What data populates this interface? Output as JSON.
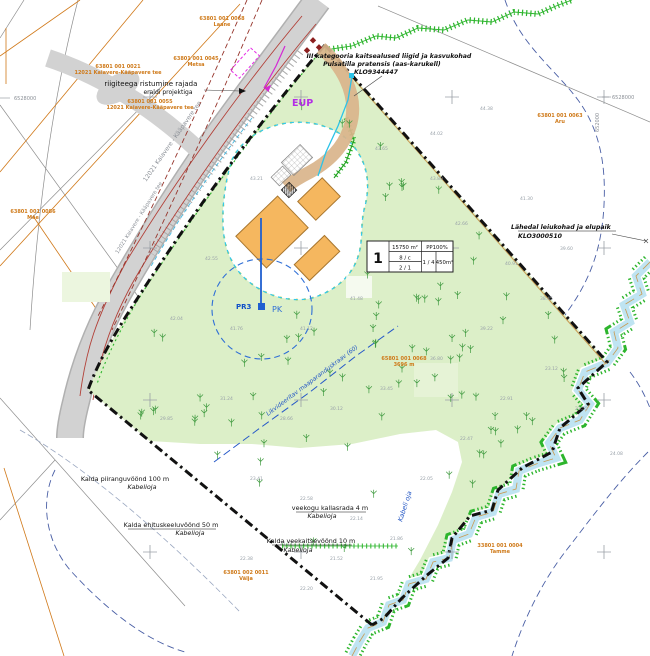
{
  "labels": {
    "road_crossing": {
      "l1": "riigiteega ristumine rajada",
      "l2": "eraldi projektiga"
    },
    "species": {
      "l1": "III kategooria kaitsealused liigid ja kasvukohad",
      "l2": "Pulsatilla pratensis (aas-karukell)",
      "l3": "KLO9344447"
    },
    "habitat": {
      "l1": "Lähedal leiukohad ja elupaik",
      "l2": "KLO3000510"
    },
    "shore_limit": {
      "l1": "Kalda piiranguvöönd 100 m",
      "l2": "Kabelioja"
    },
    "build_ban": {
      "l1": "Kalda ehituskeeluvöönd 50 m",
      "l2": "Kabelioja"
    },
    "shore_path": {
      "l1": "veekogu kallasrada 4 m",
      "l2": "Kabelioja"
    },
    "water_protect": {
      "l1": "Kalda veekaitsevöönd 10 m",
      "l2": "Kabelioja"
    },
    "ditch_label": "Likvideeritav maaparanduskraav (60)",
    "stream_name": "Kabeli oja",
    "road_name": "12021 Kaiavere - Kääpavere tee",
    "road_name2": "12021 Kaiavere - Kääpavere tee",
    "eup": "EUP",
    "pk": "PK",
    "pr3": "PR3",
    "coord_left": "6528000",
    "coord_right_h": "6528000",
    "coord_right_v": "652000"
  },
  "cadastral": [
    {
      "num": "63801 001 0068",
      "name": "Laane"
    },
    {
      "num": "63801 001 0045",
      "name": "Metsa"
    },
    {
      "num": "63801 001 0021",
      "name": "12021 Kaiavere-Kääpavere tee"
    },
    {
      "num": "63801 001 0055",
      "name": "12021 Kaiavere-Kääpavere tee"
    },
    {
      "num": "63801 001 0086",
      "name": "Mäe"
    },
    {
      "num": "65801 001 0068",
      "name": "3696 m"
    },
    {
      "num": "63801 001 0063",
      "name": "Aru"
    },
    {
      "num": "33801 001 0004",
      "name": "Tamme"
    },
    {
      "num": "63801 002 0011",
      "name": "Välja"
    }
  ],
  "plot_table": {
    "num": "1",
    "area": "15750 m²",
    "pp": "PP100%",
    "r1": "8 / c",
    "r2": "2 / 1",
    "r3": "1 / 4",
    "r4": "450m²"
  },
  "colors": {
    "site_green": "#dcefc8",
    "boundary": "#111111",
    "building_orange": "#f5b75f",
    "stream_blue": "#bfe4f2",
    "ditch_green": "#2db52d",
    "cadastral_orange": "#cf7a1a",
    "magenta": "#d428d4",
    "purple": "#b42ee6",
    "well_blue": "#2f6fd6"
  },
  "elevations": [
    {
      "x": 375,
      "y": 150,
      "v": "43.65"
    },
    {
      "x": 430,
      "y": 135,
      "v": "44.02"
    },
    {
      "x": 480,
      "y": 110,
      "v": "44.38"
    },
    {
      "x": 250,
      "y": 180,
      "v": "43.21"
    },
    {
      "x": 205,
      "y": 260,
      "v": "42.55"
    },
    {
      "x": 170,
      "y": 320,
      "v": "42.04"
    },
    {
      "x": 230,
      "y": 330,
      "v": "41.76"
    },
    {
      "x": 300,
      "y": 330,
      "v": "41.12"
    },
    {
      "x": 350,
      "y": 300,
      "v": "41.48"
    },
    {
      "x": 400,
      "y": 260,
      "v": "42.10"
    },
    {
      "x": 455,
      "y": 225,
      "v": "42.66"
    },
    {
      "x": 505,
      "y": 265,
      "v": "40.91"
    },
    {
      "x": 540,
      "y": 300,
      "v": "38.45"
    },
    {
      "x": 480,
      "y": 330,
      "v": "39.22"
    },
    {
      "x": 430,
      "y": 360,
      "v": "36.80"
    },
    {
      "x": 380,
      "y": 390,
      "v": "33.45"
    },
    {
      "x": 330,
      "y": 410,
      "v": "30.12"
    },
    {
      "x": 280,
      "y": 420,
      "v": "28.66"
    },
    {
      "x": 220,
      "y": 400,
      "v": "31.24"
    },
    {
      "x": 160,
      "y": 420,
      "v": "29.85"
    },
    {
      "x": 250,
      "y": 480,
      "v": "23.41"
    },
    {
      "x": 300,
      "y": 500,
      "v": "22.58"
    },
    {
      "x": 350,
      "y": 520,
      "v": "22.14"
    },
    {
      "x": 390,
      "y": 540,
      "v": "21.86"
    },
    {
      "x": 280,
      "y": 545,
      "v": "21.77"
    },
    {
      "x": 240,
      "y": 560,
      "v": "22.38"
    },
    {
      "x": 420,
      "y": 480,
      "v": "22.05"
    },
    {
      "x": 460,
      "y": 440,
      "v": "22.47"
    },
    {
      "x": 500,
      "y": 400,
      "v": "22.91"
    },
    {
      "x": 545,
      "y": 370,
      "v": "23.12"
    },
    {
      "x": 575,
      "y": 410,
      "v": "23.55"
    },
    {
      "x": 610,
      "y": 455,
      "v": "24.08"
    },
    {
      "x": 330,
      "y": 560,
      "v": "21.52"
    },
    {
      "x": 370,
      "y": 580,
      "v": "21.95"
    },
    {
      "x": 300,
      "y": 590,
      "v": "22.20"
    },
    {
      "x": 430,
      "y": 180,
      "v": "43.80"
    },
    {
      "x": 520,
      "y": 200,
      "v": "41.30"
    },
    {
      "x": 560,
      "y": 250,
      "v": "39.60"
    }
  ]
}
